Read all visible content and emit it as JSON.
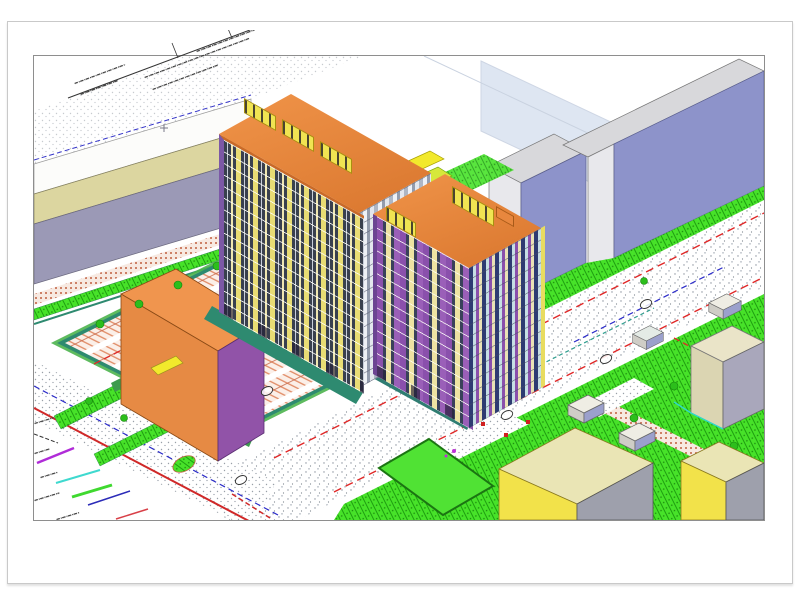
{
  "meta": {
    "drawing_type": "axonometric 3D site development plan (CAD export)",
    "legible_text": false,
    "note": "All annotation text (title block, legend labels) is rendered at sub-legible scan resolution"
  },
  "palette": {
    "roof_orange": "#E8873E",
    "tower_facade_yellow": "#E8DC74",
    "tower_facade_purple": "#8A50AC",
    "tower_window_dark": "#39415A",
    "tower_window_teal": "#C6DEE4",
    "existing_slab_front": "#8D93CA",
    "existing_slab_top": "#D8D8DB",
    "existing_slab_end": "#E8E8EC",
    "left_slab_front": "#9B99B6",
    "left_slab_band": "#DCD6A0",
    "orange_box_top": "#F0954E",
    "orange_box_front": "#E68A44",
    "orange_box_side": "#9153A8",
    "lawn_green": "#47E229",
    "playground_green": "#50E234",
    "playground_border": "#1B7512",
    "parking_stall": "#E08A64",
    "parking_border_teal": "#2E8A70",
    "strip_green": "#4DB44E",
    "dark_green_strip": "#3E9A4E",
    "road_dot_gray": "#99A0A8",
    "utility_red": "#E02828",
    "utility_blue": "#2A2AC8",
    "utility_teal": "#2F9E8E",
    "utility_cyan": "#3FD9CF",
    "utility_magenta": "#B02CD8",
    "ghost_building_blue": "#D7E1F0",
    "yellow_building_face": "#F2E24A",
    "yellow_building_top": "#EAE5B5",
    "building_gray_side": "#9EA0AC",
    "beige_building_front": "#DBD5B2",
    "beige_building_top": "#EAE4C8",
    "beige_building_side": "#A9A7BB",
    "kiosk_top": "#EFEDE4",
    "kiosk_front": "#CFCDC6",
    "kiosk_side": "#9BA0CC",
    "marker_yellow": "#F2E92C",
    "bush_green": "#2CBE1C"
  },
  "legend": {
    "labels_legible": false,
    "items": [
      {
        "name": "black-dashed-line",
        "color": "#333333",
        "style": "dashed"
      },
      {
        "name": "magenta-utility-line",
        "color": "#B02CD8",
        "style": "solid"
      },
      {
        "name": "cyan-utility-line",
        "color": "#3FD9CF",
        "style": "solid"
      },
      {
        "name": "green-utility-line",
        "color": "#3FD92F",
        "style": "solid"
      },
      {
        "name": "blue-utility-line",
        "color": "#2B2BB8",
        "style": "solid"
      },
      {
        "name": "red-utility-line",
        "color": "#D84048",
        "style": "solid"
      }
    ]
  },
  "buildings": [
    {
      "id": "tower-1",
      "kind": "new multi-storey residential tower",
      "roof": "#E8873E"
    },
    {
      "id": "tower-2",
      "kind": "new multi-storey residential tower",
      "roof": "#E8873E"
    },
    {
      "id": "slab-left",
      "kind": "existing slab building",
      "front": "#9B99B6"
    },
    {
      "id": "slab-ne-small",
      "kind": "existing slab building",
      "front": "#8D93CA"
    },
    {
      "id": "slab-ne-large",
      "kind": "existing slab building",
      "front": "#8D93CA"
    },
    {
      "id": "ghost-building",
      "kind": "planned outline",
      "fill": "#D7E1F0"
    },
    {
      "id": "orange-box-building",
      "kind": "low commercial block",
      "top": "#F0954E"
    },
    {
      "id": "beige-building",
      "kind": "low building",
      "front": "#DBD5B2"
    },
    {
      "id": "yellow-building-1",
      "kind": "low building",
      "front": "#F2E24A"
    },
    {
      "id": "yellow-building-2",
      "kind": "low building",
      "front": "#F2E24A"
    },
    {
      "id": "kiosks",
      "kind": "small service boxes",
      "count": 4
    }
  ],
  "site_features": [
    {
      "id": "parking-lot",
      "pattern": "salmon stall hatch",
      "border": "#2E8A70"
    },
    {
      "id": "main-road",
      "pattern": "gray stipple"
    },
    {
      "id": "boundary-road-sw",
      "line": "#D02828"
    },
    {
      "id": "playground",
      "fill": "#50E234"
    },
    {
      "id": "lawns",
      "fill": "#47E229"
    },
    {
      "id": "survey-circle-marks",
      "count": 5
    }
  ]
}
